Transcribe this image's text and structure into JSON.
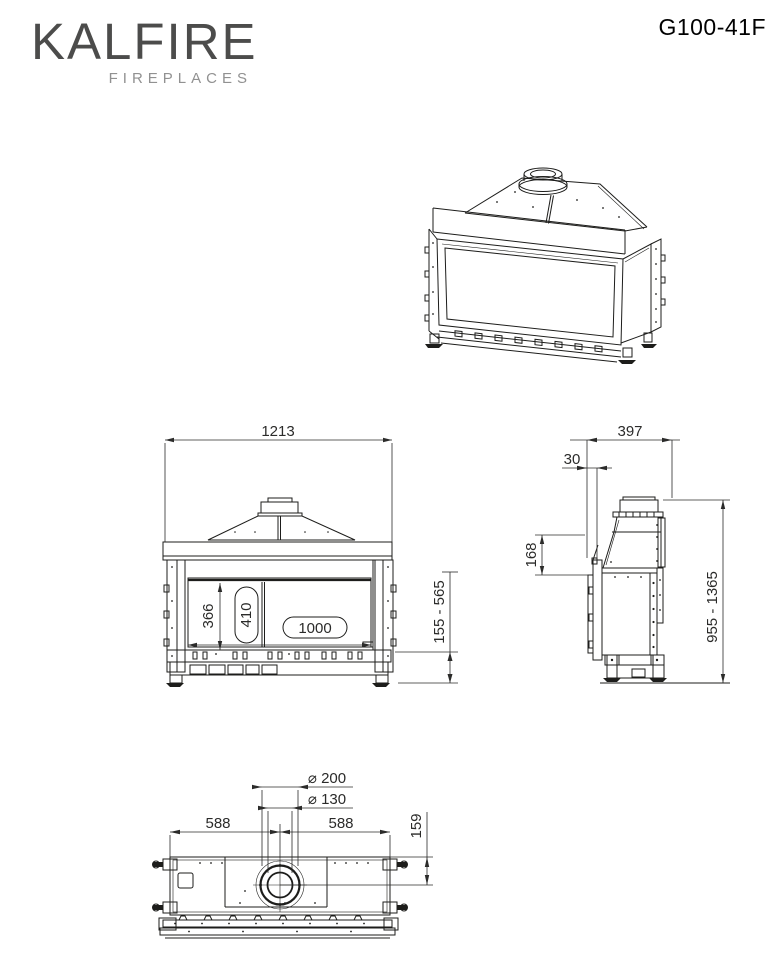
{
  "header": {
    "brand": "KALFIRE",
    "brand_subtitle": "FIREPLACES",
    "model": "G100-41F"
  },
  "dimensions": {
    "front": {
      "overall_width": "1213",
      "glass_height": "366",
      "window_height_badge": "410",
      "window_width_badge": "1000",
      "base_height_range": "155 - 565"
    },
    "side": {
      "depth": "397",
      "frame_offset": "30",
      "front_top_section": "168",
      "overall_height_range": "955 - 1365"
    },
    "top": {
      "flue_outer_diameter": "⌀ 200",
      "flue_inner_diameter": "⌀ 130",
      "center_to_left_edge": "588",
      "center_to_right_edge": "588",
      "flue_center_to_back": "159"
    }
  },
  "colors": {
    "background": "#ffffff",
    "drawing_line": "#1d1d1b",
    "dimension_text": "#2b2b2a",
    "brand_primary": "#4c4c4b",
    "brand_secondary": "#919191",
    "model_text": "#000000"
  }
}
